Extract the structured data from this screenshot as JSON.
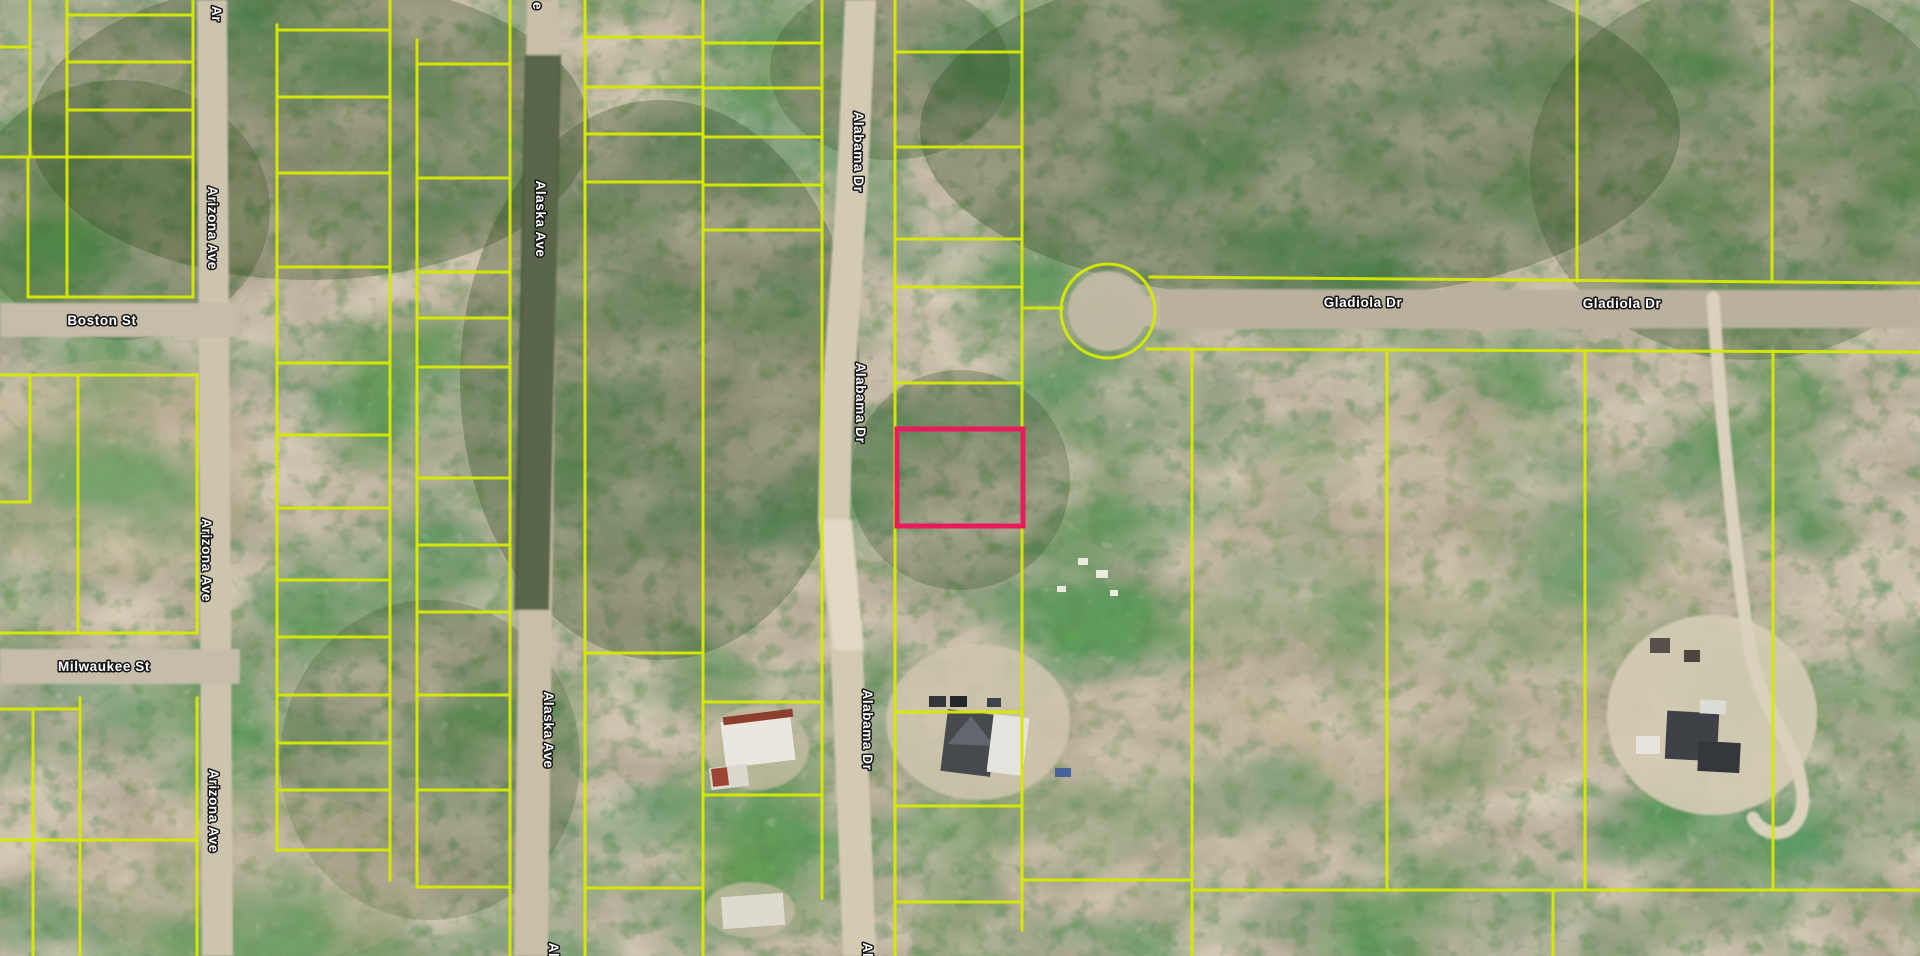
{
  "map": {
    "canvas": {
      "width": 1920,
      "height": 956
    },
    "colors": {
      "parcel_line": "#d6e900",
      "highlight": "#ea1a5e",
      "label_fill": "#ffffff",
      "label_outline": "#161616",
      "terrain_base": "#9c8a68",
      "canopy_green": "#31491f",
      "road_dirt": "#cdc4ae",
      "road_gray": "#bdb5a2"
    },
    "highlight_parcel": {
      "x": 897,
      "y": 429,
      "width": 126,
      "height": 97,
      "stroke_width": 5
    },
    "culdesac": {
      "cx": 1108,
      "cy": 311,
      "r": 47
    },
    "terrain_patches": [
      {
        "ellipse": [
          310,
          130,
          280,
          150
        ],
        "fill": "#31491f",
        "op": 0.3
      },
      {
        "ellipse": [
          120,
          210,
          150,
          130
        ],
        "fill": "#2f4a22",
        "op": 0.28
      },
      {
        "ellipse": [
          660,
          380,
          200,
          280
        ],
        "fill": "#2c471f",
        "op": 0.3
      },
      {
        "ellipse": [
          890,
          70,
          120,
          90
        ],
        "fill": "#2d4820",
        "op": 0.25
      },
      {
        "ellipse": [
          1300,
          130,
          380,
          170
        ],
        "fill": "#2c4a21",
        "op": 0.32
      },
      {
        "ellipse": [
          1750,
          170,
          220,
          190
        ],
        "fill": "#30481f",
        "op": 0.26
      },
      {
        "ellipse": [
          960,
          480,
          110,
          110
        ],
        "fill": "#2c4720",
        "op": 0.26
      },
      {
        "ellipse": [
          430,
          760,
          150,
          160
        ],
        "fill": "#2e4822",
        "op": 0.22
      },
      {
        "ellipse": [
          110,
          470,
          150,
          110
        ],
        "fill": "#c3b292",
        "op": 0.3
      },
      {
        "ellipse": [
          1450,
          600,
          260,
          200
        ],
        "fill": "#bfae8d",
        "op": 0.22
      },
      {
        "ellipse": [
          1150,
          800,
          200,
          120
        ],
        "fill": "#c0af8f",
        "op": 0.2
      },
      {
        "ellipse": [
          250,
          880,
          180,
          90
        ],
        "fill": "#c2b193",
        "op": 0.22
      }
    ],
    "ground": [
      {
        "name": "clearing-house-east",
        "ellipse": [
          978,
          722,
          92,
          78
        ],
        "fill": "#cfc5ae",
        "op": 0.85
      },
      {
        "name": "clearing-house-right",
        "ellipse": [
          1712,
          715,
          105,
          100
        ],
        "fill": "#d5ccb5",
        "op": 0.9
      },
      {
        "name": "clearing-trailer",
        "ellipse": [
          757,
          748,
          52,
          42
        ],
        "fill": "#c8bea6",
        "op": 0.75
      },
      {
        "name": "clearing-structure-b",
        "ellipse": [
          750,
          910,
          45,
          28
        ],
        "fill": "#c8bea6",
        "op": 0.7
      },
      {
        "name": "alaska-ave-road",
        "path": "M527,0 L559,0 L548,956 L514,956 Z",
        "fill": "#c9bfa7"
      },
      {
        "name": "alaska-ave-canopy",
        "path": "M525,55 L561,55 L549,610 L514,610 Z",
        "fill": "#47563a",
        "op": 0.85
      },
      {
        "name": "arizona-ave-road",
        "path": "M197,0 L227,0 L233,956 L202,956 Z",
        "fill": "#cdc4ae"
      },
      {
        "name": "alabama-dr-road",
        "path": "M845,0 L876,0 L868,180 L852,430 L850,520 L862,640 L870,800 L876,956 L843,956 L837,800 L830,640 L818,520 L820,430 L837,180 Z",
        "fill": "#d3cab3"
      },
      {
        "name": "alabama-dr-sand",
        "path": "M820,520 L852,520 L864,650 L834,650 Z",
        "fill": "#e2dac4",
        "op": 0.9
      },
      {
        "name": "boston-st-road",
        "path": "M0,303 L240,303 L240,337 L0,337 Z",
        "fill": "#c5bca9"
      },
      {
        "name": "milwaukee-st-road",
        "path": "M0,649 L240,649 L240,684 L0,684 Z",
        "fill": "#c5bca9"
      },
      {
        "name": "gladiola-dr-road",
        "path": "M1150,289 L1920,290 L1920,328 L1150,329 Z",
        "fill": "#b9b19e"
      },
      {
        "name": "culdesac-pavement",
        "ellipse": [
          1108,
          311,
          40,
          40
        ],
        "fill": "#c2b9a4",
        "op": 0.95
      },
      {
        "name": "gladiola-neck",
        "path": "M1140,296 L1160,296 L1160,326 L1140,326 Z",
        "fill": "#c2b9a4"
      },
      {
        "name": "driveway-right",
        "path": "M1713,298 C1722,430 1736,570 1752,660 C1766,720 1801,748 1803,800 C1801,838 1766,842 1753,818",
        "fill": "none",
        "stroke": "#d9d1bb",
        "sw": 13
      }
    ],
    "structures": [
      {
        "name": "trailer-roof",
        "rect": [
          723,
          718,
          70,
          46
        ],
        "fill": "#e9e7e0",
        "rot": -7
      },
      {
        "name": "trailer-trim",
        "rect": [
          723,
          713,
          70,
          8
        ],
        "fill": "#8d3f2e",
        "rot": -7
      },
      {
        "name": "trailer-shed",
        "rect": [
          710,
          766,
          38,
          22
        ],
        "fill": "#ddd8cd",
        "rot": -7
      },
      {
        "name": "trailer-shed-roof",
        "rect": [
          712,
          768,
          16,
          18
        ],
        "fill": "#9c4534",
        "rot": -7
      },
      {
        "name": "structure-b-roof",
        "rect": [
          722,
          895,
          62,
          32
        ],
        "fill": "#dedacf",
        "rot": -4
      },
      {
        "name": "house-east-dark",
        "rect": [
          944,
          712,
          50,
          62
        ],
        "fill": "#46494d",
        "rot": 7
      },
      {
        "name": "house-east-gable",
        "path": "M948,744 L971,716 L994,746 Z",
        "fill": "#63676d"
      },
      {
        "name": "house-east-white",
        "rect": [
          990,
          716,
          36,
          58
        ],
        "fill": "#e4e4df",
        "rot": 7
      },
      {
        "name": "car-1",
        "rect": [
          929,
          696,
          17,
          11
        ],
        "fill": "#33373c"
      },
      {
        "name": "car-2",
        "rect": [
          950,
          696,
          17,
          11
        ],
        "fill": "#24282c"
      },
      {
        "name": "car-3",
        "rect": [
          987,
          698,
          14,
          9
        ],
        "fill": "#3c424a"
      },
      {
        "name": "car-blue",
        "rect": [
          1055,
          768,
          16,
          9
        ],
        "fill": "#46639a"
      },
      {
        "name": "house-right-main",
        "rect": [
          1666,
          712,
          52,
          48
        ],
        "fill": "#3e4246",
        "rot": 3
      },
      {
        "name": "house-right-wing",
        "rect": [
          1698,
          742,
          42,
          30
        ],
        "fill": "#34383d",
        "rot": 3
      },
      {
        "name": "house-right-roof-light",
        "rect": [
          1700,
          700,
          26,
          14
        ],
        "fill": "#dcdcd6",
        "rot": 3
      },
      {
        "name": "shed-white",
        "rect": [
          1636,
          736,
          24,
          18
        ],
        "fill": "#e7e5db"
      },
      {
        "name": "shed-dark-1",
        "rect": [
          1650,
          638,
          20,
          15
        ],
        "fill": "#57504a"
      },
      {
        "name": "shed-dark-2",
        "rect": [
          1684,
          650,
          16,
          12
        ],
        "fill": "#4c463f"
      },
      {
        "name": "debris-1",
        "rect": [
          1078,
          558,
          10,
          7
        ],
        "fill": "#eceadf"
      },
      {
        "name": "debris-2",
        "rect": [
          1096,
          570,
          12,
          8
        ],
        "fill": "#eceadf"
      },
      {
        "name": "debris-3",
        "rect": [
          1057,
          586,
          9,
          6
        ],
        "fill": "#eceadf"
      },
      {
        "name": "debris-4",
        "rect": [
          1110,
          590,
          8,
          6
        ],
        "fill": "#eceadf"
      }
    ],
    "parcel_lines": [
      [
        30,
        0,
        30,
        155
      ],
      [
        67,
        0,
        67,
        297
      ],
      [
        193,
        0,
        193,
        297
      ],
      [
        28,
        157,
        28,
        297
      ],
      [
        67,
        15,
        193,
        15
      ],
      [
        0,
        47,
        30,
        47
      ],
      [
        67,
        62,
        193,
        62
      ],
      [
        67,
        110,
        193,
        110
      ],
      [
        0,
        157,
        193,
        157
      ],
      [
        28,
        297,
        193,
        297
      ],
      [
        0,
        375,
        197,
        375
      ],
      [
        30,
        375,
        30,
        502
      ],
      [
        78,
        375,
        78,
        633
      ],
      [
        197,
        375,
        197,
        633
      ],
      [
        0,
        502,
        30,
        502
      ],
      [
        0,
        633,
        197,
        633
      ],
      [
        33,
        712,
        33,
        956
      ],
      [
        80,
        698,
        80,
        956
      ],
      [
        197,
        698,
        197,
        956
      ],
      [
        0,
        709,
        80,
        709
      ],
      [
        0,
        840,
        197,
        840
      ],
      [
        277,
        25,
        277,
        850
      ],
      [
        390,
        0,
        390,
        880
      ],
      [
        277,
        30,
        390,
        30
      ],
      [
        277,
        97,
        390,
        97
      ],
      [
        277,
        173,
        390,
        173
      ],
      [
        277,
        267,
        390,
        267
      ],
      [
        277,
        363,
        390,
        363
      ],
      [
        277,
        435,
        390,
        435
      ],
      [
        277,
        508,
        390,
        508
      ],
      [
        277,
        580,
        390,
        580
      ],
      [
        277,
        637,
        390,
        637
      ],
      [
        277,
        695,
        390,
        695
      ],
      [
        277,
        743,
        390,
        743
      ],
      [
        277,
        790,
        390,
        790
      ],
      [
        277,
        850,
        390,
        850
      ],
      [
        417,
        40,
        417,
        887
      ],
      [
        510,
        0,
        510,
        956
      ],
      [
        417,
        64,
        510,
        64
      ],
      [
        417,
        178,
        510,
        178
      ],
      [
        417,
        272,
        510,
        272
      ],
      [
        417,
        318,
        510,
        318
      ],
      [
        417,
        367,
        510,
        367
      ],
      [
        417,
        478,
        510,
        478
      ],
      [
        417,
        545,
        510,
        545
      ],
      [
        417,
        612,
        510,
        612
      ],
      [
        417,
        695,
        510,
        695
      ],
      [
        417,
        790,
        510,
        790
      ],
      [
        417,
        887,
        510,
        887
      ],
      [
        585,
        0,
        585,
        956
      ],
      [
        703,
        0,
        703,
        956
      ],
      [
        585,
        37,
        703,
        37
      ],
      [
        585,
        87,
        703,
        87
      ],
      [
        585,
        134,
        703,
        134
      ],
      [
        585,
        182,
        703,
        182
      ],
      [
        585,
        653,
        703,
        653
      ],
      [
        585,
        888,
        703,
        888
      ],
      [
        822,
        0,
        822,
        898
      ],
      [
        703,
        43,
        822,
        43
      ],
      [
        703,
        88,
        822,
        88
      ],
      [
        703,
        137,
        822,
        137
      ],
      [
        703,
        185,
        822,
        185
      ],
      [
        703,
        230,
        822,
        230
      ],
      [
        703,
        702,
        822,
        702
      ],
      [
        703,
        795,
        822,
        795
      ],
      [
        895,
        0,
        895,
        956
      ],
      [
        1022,
        0,
        1022,
        930
      ],
      [
        895,
        52,
        1022,
        52
      ],
      [
        895,
        147,
        1022,
        147
      ],
      [
        895,
        239,
        1022,
        239
      ],
      [
        895,
        287,
        1022,
        287
      ],
      [
        895,
        383,
        1022,
        383
      ],
      [
        895,
        712,
        1022,
        712
      ],
      [
        895,
        806,
        1022,
        806
      ],
      [
        895,
        902,
        1022,
        902
      ],
      [
        1022,
        308,
        1062,
        308
      ],
      [
        1150,
        277,
        1920,
        283
      ],
      [
        1147,
        349,
        1920,
        352
      ],
      [
        1577,
        0,
        1577,
        281
      ],
      [
        1772,
        0,
        1772,
        282
      ],
      [
        1192,
        351,
        1192,
        956
      ],
      [
        1387,
        351,
        1387,
        890
      ],
      [
        1585,
        351,
        1585,
        890
      ],
      [
        1773,
        351,
        1773,
        890
      ],
      [
        1022,
        880,
        1192,
        880
      ],
      [
        1192,
        890,
        1920,
        890
      ],
      [
        1553,
        890,
        1553,
        956
      ]
    ],
    "street_labels": [
      {
        "text": "Ar",
        "x": 217,
        "y": 14,
        "rotate": 90
      },
      {
        "text": "Arizona Ave",
        "x": 213,
        "y": 228,
        "rotate": 90
      },
      {
        "text": "Boston St",
        "x": 102,
        "y": 320,
        "rotate": 0
      },
      {
        "text": "Arizona Ave",
        "x": 207,
        "y": 560,
        "rotate": 90
      },
      {
        "text": "Milwaukee St",
        "x": 104,
        "y": 666,
        "rotate": 0
      },
      {
        "text": "Arizona Ave",
        "x": 214,
        "y": 811,
        "rotate": 90
      },
      {
        "text": "e",
        "x": 538,
        "y": 6,
        "rotate": 90
      },
      {
        "text": "Alaska Ave",
        "x": 541,
        "y": 219,
        "rotate": 90
      },
      {
        "text": "Alaska Ave",
        "x": 549,
        "y": 730,
        "rotate": 90
      },
      {
        "text": "Al",
        "x": 554,
        "y": 950,
        "rotate": 90
      },
      {
        "text": "Alabama Dr",
        "x": 859,
        "y": 152,
        "rotate": 90
      },
      {
        "text": "Alabama Dr",
        "x": 861,
        "y": 403,
        "rotate": 90
      },
      {
        "text": "Alabama Dr",
        "x": 868,
        "y": 730,
        "rotate": 90
      },
      {
        "text": "Al",
        "x": 868,
        "y": 950,
        "rotate": 90
      },
      {
        "text": "Gladiola Dr",
        "x": 1363,
        "y": 302,
        "rotate": 0
      },
      {
        "text": "Gladiola Dr",
        "x": 1622,
        "y": 303,
        "rotate": 0
      }
    ]
  }
}
